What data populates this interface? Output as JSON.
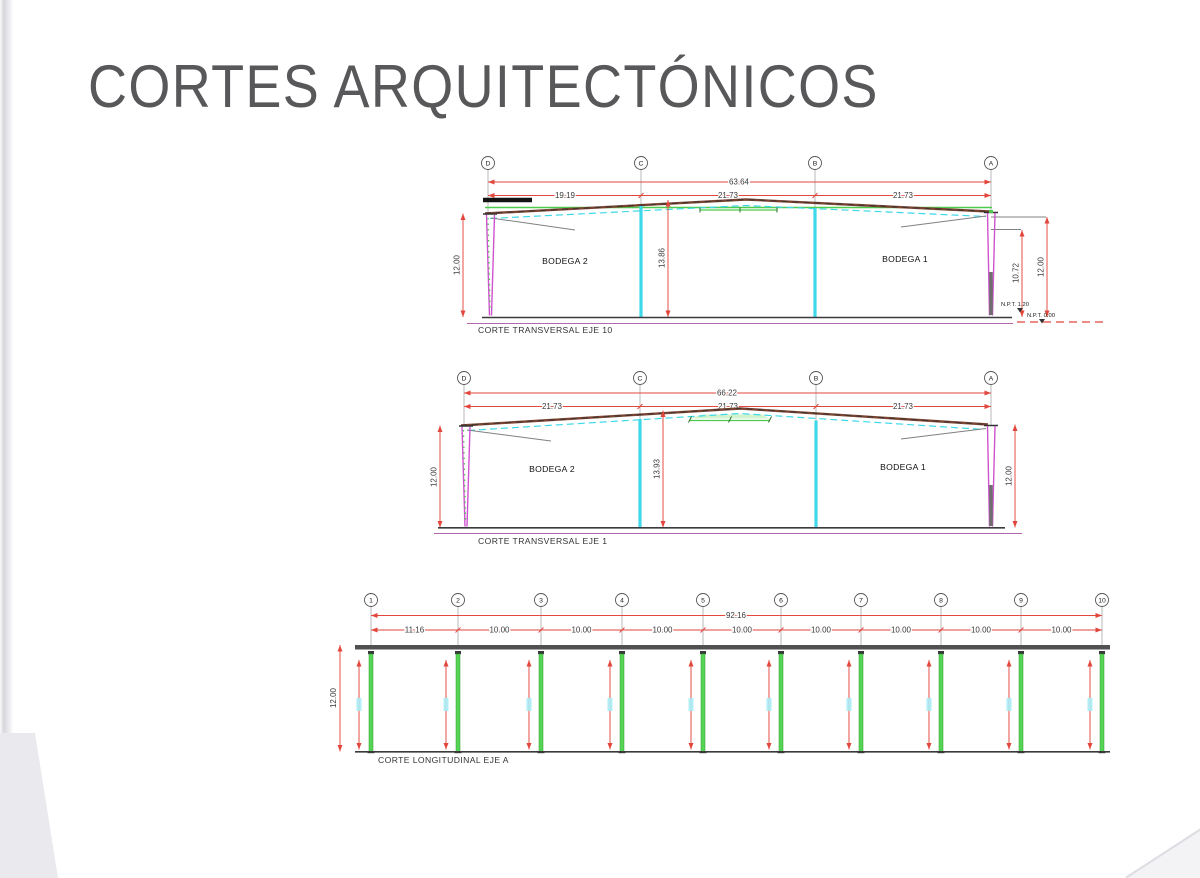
{
  "title": "CORTES ARQUITECTÓNICOS",
  "colors": {
    "title_gray": "#58585a",
    "dim_red": "#e2473d",
    "cad_cyan": "#3ed8e8",
    "cad_green": "#4ecb4e",
    "cad_magenta": "#cf52cf",
    "roof_brown": "#7a4433",
    "floor_purple": "#b168ae",
    "beam_gray": "#515154",
    "text_dark": "#333333"
  },
  "sections": {
    "eje10": {
      "caption": "CORTE TRANSVERSAL EJE 10",
      "grid": [
        "D",
        "C",
        "B",
        "A"
      ],
      "dim_total": "63.64",
      "spans": [
        "19.19",
        "21.73",
        "21.73"
      ],
      "h_left": "12.00",
      "h_center": "13.86",
      "h_right_inner": "10.72",
      "h_right_outer": "12.00",
      "room_left": "BODEGA 2",
      "room_right": "BODEGA 1",
      "npt_upper": "N.P.T. 1.20",
      "npt_lower": "N.P.T. 0.00"
    },
    "eje1": {
      "caption": "CORTE TRANSVERSAL EJE 1",
      "grid": [
        "D",
        "C",
        "B",
        "A"
      ],
      "dim_total": "66.22",
      "spans": [
        "21.73",
        "21.73",
        "21.73"
      ],
      "h_left": "12.00",
      "h_center": "13.93",
      "h_right": "12.00",
      "room_left": "BODEGA 2",
      "room_right": "BODEGA 1"
    },
    "ejeA": {
      "caption": "CORTE LONGITUDINAL EJE A",
      "grid": [
        "1",
        "2",
        "3",
        "4",
        "5",
        "6",
        "7",
        "8",
        "9",
        "10"
      ],
      "dim_total": "92.16",
      "spans": [
        "11.16",
        "10.00",
        "10.00",
        "10.00",
        "10.00",
        "10.00",
        "10.00",
        "10.00",
        "10.00"
      ],
      "h_left": "12.00"
    }
  }
}
